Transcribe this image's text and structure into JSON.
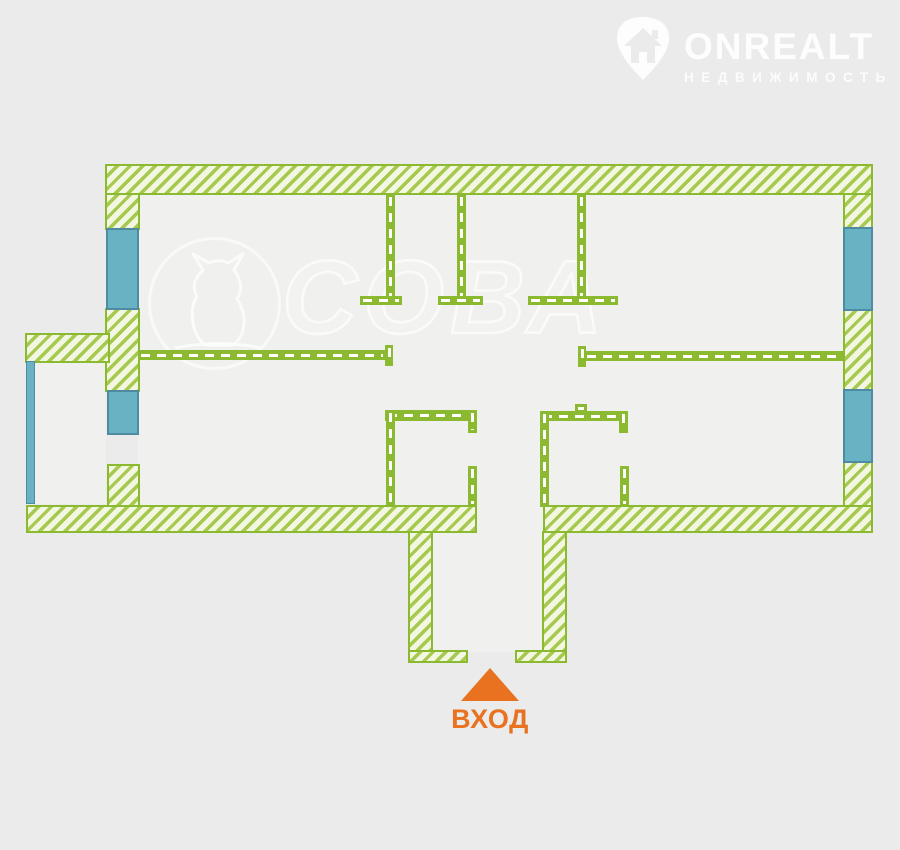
{
  "page": {
    "width": 900,
    "height": 850
  },
  "branding": {
    "logo": {
      "name": "ONREALT",
      "subtitle": "НЕДВИЖИМОСТЬ"
    },
    "watermark": {
      "text": "СОВА"
    }
  },
  "entrance": {
    "label": "ВХОД"
  },
  "palette": {
    "page_bg": "#ebebec",
    "interior_fill": "#f0f1ee",
    "wall_green": "#8bb92f",
    "hatch_fill": "#f3f6e1",
    "hatch_stripe": "#a6c94f",
    "window_fill": "#68b2c4",
    "window_border": "#4e8ba2",
    "accent_orange": "#e8721f"
  },
  "plan": {
    "interior_regions": [
      {
        "name": "interior-main",
        "x": 138,
        "y": 194,
        "w": 706,
        "h": 313
      },
      {
        "name": "interior-balcony",
        "x": 34,
        "y": 361,
        "w": 72,
        "h": 143
      },
      {
        "name": "interior-entry-gap",
        "x": 477,
        "y": 505,
        "w": 66,
        "h": 30
      },
      {
        "name": "interior-entry-hall",
        "x": 433,
        "y": 531,
        "w": 109,
        "h": 121
      }
    ],
    "hatched_walls": [
      {
        "name": "outer-wall-top",
        "x": 105,
        "y": 164,
        "w": 768,
        "h": 31
      },
      {
        "name": "outer-wall-left-upper",
        "x": 105,
        "y": 193,
        "w": 35,
        "h": 37
      },
      {
        "name": "outer-wall-left-mid",
        "x": 105,
        "y": 308,
        "w": 35,
        "h": 84
      },
      {
        "name": "outer-wall-left-lower",
        "x": 107,
        "y": 464,
        "w": 33,
        "h": 43
      },
      {
        "name": "balcony-wall-top",
        "x": 25,
        "y": 333,
        "w": 85,
        "h": 30
      },
      {
        "name": "outer-wall-bottom-left",
        "x": 26,
        "y": 505,
        "w": 451,
        "h": 28
      },
      {
        "name": "outer-wall-bottom-right",
        "x": 543,
        "y": 505,
        "w": 330,
        "h": 28
      },
      {
        "name": "outer-wall-right-upper",
        "x": 843,
        "y": 193,
        "w": 30,
        "h": 36
      },
      {
        "name": "outer-wall-right-mid",
        "x": 843,
        "y": 309,
        "w": 30,
        "h": 82
      },
      {
        "name": "outer-wall-right-lower",
        "x": 843,
        "y": 461,
        "w": 30,
        "h": 46
      },
      {
        "name": "entry-wall-left",
        "x": 408,
        "y": 531,
        "w": 25,
        "h": 132
      },
      {
        "name": "entry-wall-left-foot",
        "x": 408,
        "y": 650,
        "w": 60,
        "h": 13
      },
      {
        "name": "entry-wall-right",
        "x": 542,
        "y": 531,
        "w": 25,
        "h": 132
      },
      {
        "name": "entry-wall-right-foot",
        "x": 515,
        "y": 650,
        "w": 52,
        "h": 13
      }
    ],
    "windows": [
      {
        "name": "window-left-upper",
        "x": 106,
        "y": 228,
        "w": 33,
        "h": 82
      },
      {
        "name": "window-left-lower",
        "x": 107,
        "y": 390,
        "w": 32,
        "h": 45
      },
      {
        "name": "window-balcony",
        "x": 26,
        "y": 361,
        "w": 9,
        "h": 143,
        "thin": true
      },
      {
        "name": "window-right-upper",
        "x": 843,
        "y": 227,
        "w": 30,
        "h": 84
      },
      {
        "name": "window-right-lower",
        "x": 843,
        "y": 389,
        "w": 30,
        "h": 74
      }
    ],
    "interior_walls": [
      {
        "name": "partition-top-1",
        "x": 386,
        "y": 194,
        "w": 9,
        "h": 109,
        "dir": "v"
      },
      {
        "name": "partition-top-2",
        "x": 457,
        "y": 194,
        "w": 9,
        "h": 109,
        "dir": "v"
      },
      {
        "name": "partition-top-3",
        "x": 577,
        "y": 194,
        "w": 9,
        "h": 109,
        "dir": "v"
      },
      {
        "name": "partition-foot-1",
        "x": 360,
        "y": 296,
        "w": 42,
        "h": 9,
        "dir": "h"
      },
      {
        "name": "partition-foot-2",
        "x": 438,
        "y": 296,
        "w": 45,
        "h": 9,
        "dir": "h"
      },
      {
        "name": "partition-foot-3",
        "x": 528,
        "y": 296,
        "w": 90,
        "h": 9,
        "dir": "h"
      },
      {
        "name": "mid-wall-left",
        "x": 138,
        "y": 350,
        "w": 248,
        "h": 10,
        "dir": "h"
      },
      {
        "name": "mid-wall-left-cap",
        "x": 385,
        "y": 345,
        "w": 8,
        "h": 21,
        "dir": "v"
      },
      {
        "name": "mid-wall-right-cap",
        "x": 578,
        "y": 346,
        "w": 8,
        "h": 21,
        "dir": "v"
      },
      {
        "name": "mid-wall-right",
        "x": 584,
        "y": 351,
        "w": 259,
        "h": 10,
        "dir": "h"
      },
      {
        "name": "room-left-wall-top",
        "x": 385,
        "y": 410,
        "w": 92,
        "h": 11,
        "dir": "h"
      },
      {
        "name": "room-left-wall-side",
        "x": 386,
        "y": 410,
        "w": 9,
        "h": 97,
        "dir": "v"
      },
      {
        "name": "room-left-stub-upper",
        "x": 468,
        "y": 410,
        "w": 9,
        "h": 23,
        "dir": "v"
      },
      {
        "name": "room-left-stub-lower",
        "x": 468,
        "y": 466,
        "w": 9,
        "h": 41,
        "dir": "v"
      },
      {
        "name": "room-right-wall-top",
        "x": 540,
        "y": 411,
        "w": 88,
        "h": 10,
        "dir": "h"
      },
      {
        "name": "room-right-wall-side",
        "x": 540,
        "y": 411,
        "w": 9,
        "h": 96,
        "dir": "v"
      },
      {
        "name": "room-right-nub",
        "x": 575,
        "y": 404,
        "w": 12,
        "h": 8,
        "dir": "h"
      },
      {
        "name": "room-right-stub-upper",
        "x": 619,
        "y": 411,
        "w": 9,
        "h": 22,
        "dir": "v"
      },
      {
        "name": "room-right-stub-lower",
        "x": 620,
        "y": 466,
        "w": 9,
        "h": 41,
        "dir": "v"
      }
    ]
  }
}
